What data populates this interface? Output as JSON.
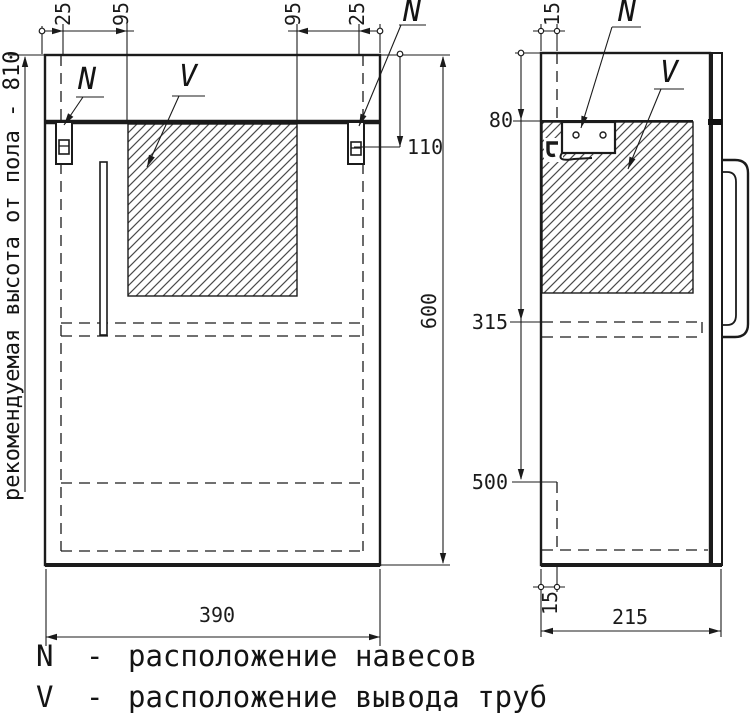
{
  "front_view": {
    "top_dimensions": [
      "25",
      "95",
      "95",
      "25"
    ],
    "hanger_drop_dim": "110",
    "height_dim": "600",
    "width_dim": "390",
    "hanger_marker_left": "N",
    "hanger_marker_right": "N",
    "pipe_marker": "V"
  },
  "side_view": {
    "top_inset_dim": "15",
    "hanger_level_dim": "80",
    "pipe_zone_dim": "315",
    "shelf_level_dim": "500",
    "bottom_inset_dim": "15",
    "depth_dim": "215",
    "hanger_marker": "N",
    "pipe_marker": "V"
  },
  "annotations": {
    "recommended_height_note": "рекомендуемая высота от пола - 810"
  },
  "legend": {
    "items": [
      {
        "symbol": "N",
        "separator": "-",
        "description": "расположение навесов"
      },
      {
        "symbol": "V",
        "separator": "-",
        "description": "расположение вывода труб"
      }
    ]
  },
  "colors": {
    "line": "#1b1b1b",
    "background": "#ffffff"
  }
}
